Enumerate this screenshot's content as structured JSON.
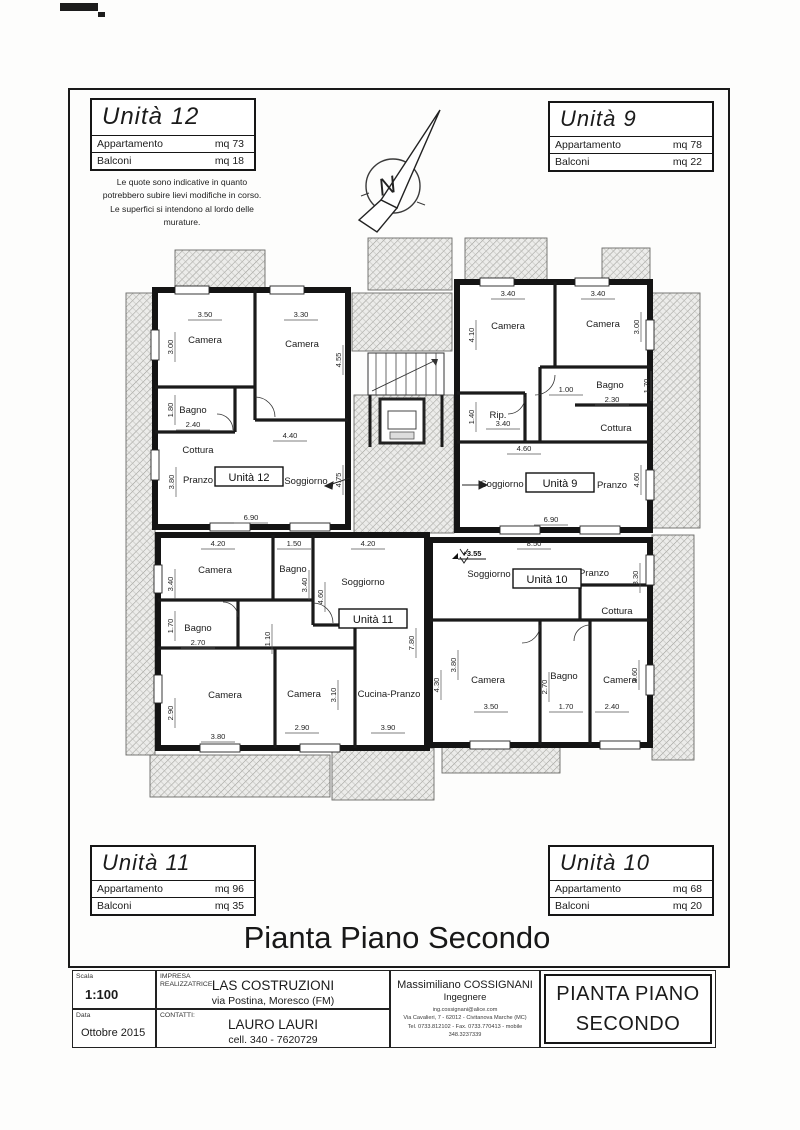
{
  "sheet": {
    "title": "Pianta Piano Secondo",
    "note_lines": [
      "Le quote sono indicative in quanto",
      "potrebbero subire lievi modifiche in corso.",
      "Le superfici si intendono al lordo delle",
      "murature."
    ]
  },
  "unit_boxes": [
    {
      "title": "Unità 12",
      "rows": [
        {
          "label": "Appartamento",
          "value": "mq  73"
        },
        {
          "label": "Balconi",
          "value": "mq  18"
        }
      ]
    },
    {
      "title": "Unità 9",
      "rows": [
        {
          "label": "Appartamento",
          "value": "mq  78"
        },
        {
          "label": "Balconi",
          "value": "mq  22"
        }
      ]
    },
    {
      "title": "Unità 11",
      "rows": [
        {
          "label": "Appartamento",
          "value": "mq  96"
        },
        {
          "label": "Balconi",
          "value": "mq  35"
        }
      ]
    },
    {
      "title": "Unità 10",
      "rows": [
        {
          "label": "Appartamento",
          "value": "mq  68"
        },
        {
          "label": "Balconi",
          "value": "mq  20"
        }
      ]
    }
  ],
  "plan": {
    "north_icon": "north-arrow",
    "level_marker": {
      "text": "+3.55",
      "x": 352,
      "y": 321
    },
    "unit_tags": [
      {
        "text": "Unità 12",
        "x": 129,
        "y": 242
      },
      {
        "text": "Unità 9",
        "x": 440,
        "y": 248
      },
      {
        "text": "Unità 11",
        "x": 253,
        "y": 384
      },
      {
        "text": "Unità 10",
        "x": 427,
        "y": 344
      }
    ],
    "room_labels": [
      {
        "text": "Camera",
        "x": 85,
        "y": 108
      },
      {
        "text": "Camera",
        "x": 182,
        "y": 112
      },
      {
        "text": "Bagno",
        "x": 73,
        "y": 178
      },
      {
        "text": "Cottura",
        "x": 78,
        "y": 218
      },
      {
        "text": "Pranzo",
        "x": 78,
        "y": 248
      },
      {
        "text": "Soggiorno",
        "x": 186,
        "y": 249
      },
      {
        "text": "Camera",
        "x": 388,
        "y": 94
      },
      {
        "text": "Camera",
        "x": 483,
        "y": 92
      },
      {
        "text": "Rip.",
        "x": 378,
        "y": 183
      },
      {
        "text": "Bagno",
        "x": 490,
        "y": 153
      },
      {
        "text": "Cottura",
        "x": 496,
        "y": 196
      },
      {
        "text": "Soggiorno",
        "x": 382,
        "y": 252
      },
      {
        "text": "Pranzo",
        "x": 492,
        "y": 253
      },
      {
        "text": "Camera",
        "x": 95,
        "y": 338
      },
      {
        "text": "Bagno",
        "x": 173,
        "y": 337
      },
      {
        "text": "Soggiorno",
        "x": 243,
        "y": 350
      },
      {
        "text": "Bagno",
        "x": 78,
        "y": 396
      },
      {
        "text": "Camera",
        "x": 105,
        "y": 463
      },
      {
        "text": "Camera",
        "x": 184,
        "y": 462
      },
      {
        "text": "Cucina-Pranzo",
        "x": 269,
        "y": 462
      },
      {
        "text": "Soggiorno",
        "x": 369,
        "y": 342
      },
      {
        "text": "Pranzo",
        "x": 474,
        "y": 341
      },
      {
        "text": "Cottura",
        "x": 497,
        "y": 379
      },
      {
        "text": "Camera",
        "x": 368,
        "y": 448
      },
      {
        "text": "Bagno",
        "x": 444,
        "y": 444
      },
      {
        "text": "Camera",
        "x": 500,
        "y": 448
      }
    ],
    "dim_labels": [
      {
        "text": "3.50",
        "x": 85,
        "y": 82,
        "o": "h"
      },
      {
        "text": "3.30",
        "x": 181,
        "y": 82,
        "o": "h"
      },
      {
        "text": "3.00",
        "x": 51,
        "y": 112,
        "o": "v"
      },
      {
        "text": "4.55",
        "x": 219,
        "y": 125,
        "o": "v"
      },
      {
        "text": "1.80",
        "x": 51,
        "y": 175,
        "o": "v"
      },
      {
        "text": "2.40",
        "x": 73,
        "y": 192,
        "o": "h"
      },
      {
        "text": "4.40",
        "x": 170,
        "y": 203,
        "o": "h"
      },
      {
        "text": "3.80",
        "x": 52,
        "y": 247,
        "o": "v"
      },
      {
        "text": "4.75",
        "x": 219,
        "y": 245,
        "o": "v"
      },
      {
        "text": "6.90",
        "x": 131,
        "y": 285,
        "o": "h"
      },
      {
        "text": "3.40",
        "x": 388,
        "y": 61,
        "o": "h"
      },
      {
        "text": "3.40",
        "x": 478,
        "y": 61,
        "o": "h"
      },
      {
        "text": "4.10",
        "x": 352,
        "y": 100,
        "o": "v"
      },
      {
        "text": "3.00",
        "x": 517,
        "y": 92,
        "o": "v"
      },
      {
        "text": "1.00",
        "x": 446,
        "y": 157,
        "o": "h"
      },
      {
        "text": "2.30",
        "x": 492,
        "y": 167,
        "o": "h"
      },
      {
        "text": "1.70",
        "x": 527,
        "y": 151,
        "o": "v"
      },
      {
        "text": "1.40",
        "x": 352,
        "y": 182,
        "o": "v"
      },
      {
        "text": "3.40",
        "x": 383,
        "y": 191,
        "o": "h"
      },
      {
        "text": "4.60",
        "x": 404,
        "y": 216,
        "o": "h"
      },
      {
        "text": "4.60",
        "x": 517,
        "y": 245,
        "o": "v"
      },
      {
        "text": "6.90",
        "x": 431,
        "y": 287,
        "o": "h"
      },
      {
        "text": "4.20",
        "x": 98,
        "y": 311,
        "o": "h"
      },
      {
        "text": "1.50",
        "x": 174,
        "y": 311,
        "o": "h"
      },
      {
        "text": "4.20",
        "x": 248,
        "y": 311,
        "o": "h"
      },
      {
        "text": "3.40",
        "x": 51,
        "y": 349,
        "o": "v"
      },
      {
        "text": "3.40",
        "x": 185,
        "y": 350,
        "o": "v"
      },
      {
        "text": "4.60",
        "x": 201,
        "y": 362,
        "o": "v"
      },
      {
        "text": "1.70",
        "x": 51,
        "y": 391,
        "o": "v"
      },
      {
        "text": "2.70",
        "x": 78,
        "y": 410,
        "o": "h"
      },
      {
        "text": "1.10",
        "x": 148,
        "y": 404,
        "o": "v"
      },
      {
        "text": "2.90",
        "x": 51,
        "y": 478,
        "o": "v"
      },
      {
        "text": "3.10",
        "x": 214,
        "y": 460,
        "o": "v"
      },
      {
        "text": "7.80",
        "x": 292,
        "y": 408,
        "o": "v"
      },
      {
        "text": "3.80",
        "x": 98,
        "y": 504,
        "o": "h"
      },
      {
        "text": "2.90",
        "x": 182,
        "y": 495,
        "o": "h"
      },
      {
        "text": "3.90",
        "x": 268,
        "y": 495,
        "o": "h"
      },
      {
        "text": "8.50",
        "x": 414,
        "y": 311,
        "o": "h"
      },
      {
        "text": "3.30",
        "x": 516,
        "y": 343,
        "o": "v"
      },
      {
        "text": "3.80",
        "x": 334,
        "y": 430,
        "o": "v"
      },
      {
        "text": "4.30",
        "x": 317,
        "y": 450,
        "o": "v"
      },
      {
        "text": "2.70",
        "x": 425,
        "y": 452,
        "o": "v"
      },
      {
        "text": "3.60",
        "x": 515,
        "y": 440,
        "o": "v"
      },
      {
        "text": "3.50",
        "x": 371,
        "y": 474,
        "o": "h"
      },
      {
        "text": "1.70",
        "x": 446,
        "y": 474,
        "o": "h"
      },
      {
        "text": "2.40",
        "x": 492,
        "y": 474,
        "o": "h"
      }
    ]
  },
  "titleblock": {
    "scala_label": "Scala",
    "scala_value": "1:100",
    "data_label": "Data",
    "data_value": "Ottobre 2015",
    "impresa_label": "IMPRESA\nREALIZZATRICE:",
    "impresa_name": "LAS COSTRUZIONI",
    "impresa_address": "via Postina, Moresco (FM)",
    "contatti_label": "CONTATTI:",
    "contatti_name": "LAURO LAURI",
    "contatti_phone": "cell. 340 - 7620729",
    "engineer_name": "Massimiliano COSSIGNANI",
    "engineer_title": "Ingegnere",
    "engineer_email": "ing.cossignani@alice.com",
    "engineer_address": "Via Cavalieri, 7 - 62012 - Civitanova Marche (MC)",
    "engineer_phone": "Tel. 0733.812102 - Fax. 0733.770413 - mobile 348.3237339",
    "drawing_title_line1": "PIANTA PIANO",
    "drawing_title_line2": "SECONDO"
  }
}
